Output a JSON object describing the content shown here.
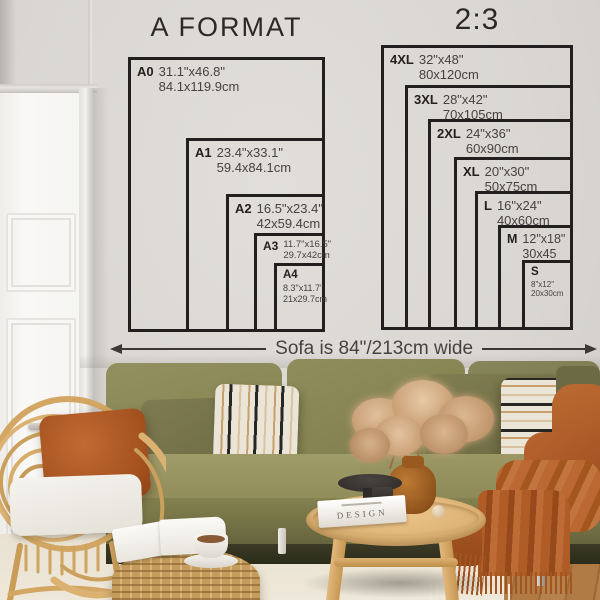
{
  "charts": {
    "a_format": {
      "title": "A FORMAT",
      "sizes": [
        {
          "code": "A0",
          "inches": "31.1\"x46.8\"",
          "cm": "84.1x119.9cm"
        },
        {
          "code": "A1",
          "inches": "23.4\"x33.1\"",
          "cm": "59.4x84.1cm"
        },
        {
          "code": "A2",
          "inches": "16.5\"x23.4\"",
          "cm": "42x59.4cm"
        },
        {
          "code": "A3",
          "inches": "11.7\"x16.5\"",
          "cm": "29.7x42cm"
        },
        {
          "code": "A4",
          "inches": "8.3\"x11.7\"",
          "cm": "21x29.7cm"
        }
      ]
    },
    "ratio_2_3": {
      "title": "2:3",
      "sizes": [
        {
          "code": "4XL",
          "inches": "32\"x48\"",
          "cm": "80x120cm"
        },
        {
          "code": "3XL",
          "inches": "28\"x42\"",
          "cm": "70x105cm"
        },
        {
          "code": "2XL",
          "inches": "24\"x36\"",
          "cm": "60x90cm"
        },
        {
          "code": "XL",
          "inches": "20\"x30\"",
          "cm": "50x75cm"
        },
        {
          "code": "L",
          "inches": "16\"x24\"",
          "cm": "40x60cm"
        },
        {
          "code": "M",
          "inches": "12\"x18\"",
          "cm": "30x45"
        },
        {
          "code": "S",
          "inches": "8\"x12\"",
          "cm": "20x30cm"
        }
      ]
    }
  },
  "sofa_note": {
    "label": "Sofa is 84\"/213cm wide"
  },
  "decor": {
    "book_spine": "DESIGN"
  },
  "colors": {
    "wall": "#dcd9d5",
    "chart_line": "#22201e",
    "sofa_olive": "#8d8a58",
    "pillow_dark_olive": "#75734a",
    "pillow_stripe_base": "#ebe5d8",
    "terracotta": "#b05c2a",
    "rattan": "#d3a763",
    "table_wood": "#dcb072",
    "rug": "#e9e2d2",
    "floor_wood": "#ab7440",
    "vase_amber": "#9a5a1f"
  }
}
